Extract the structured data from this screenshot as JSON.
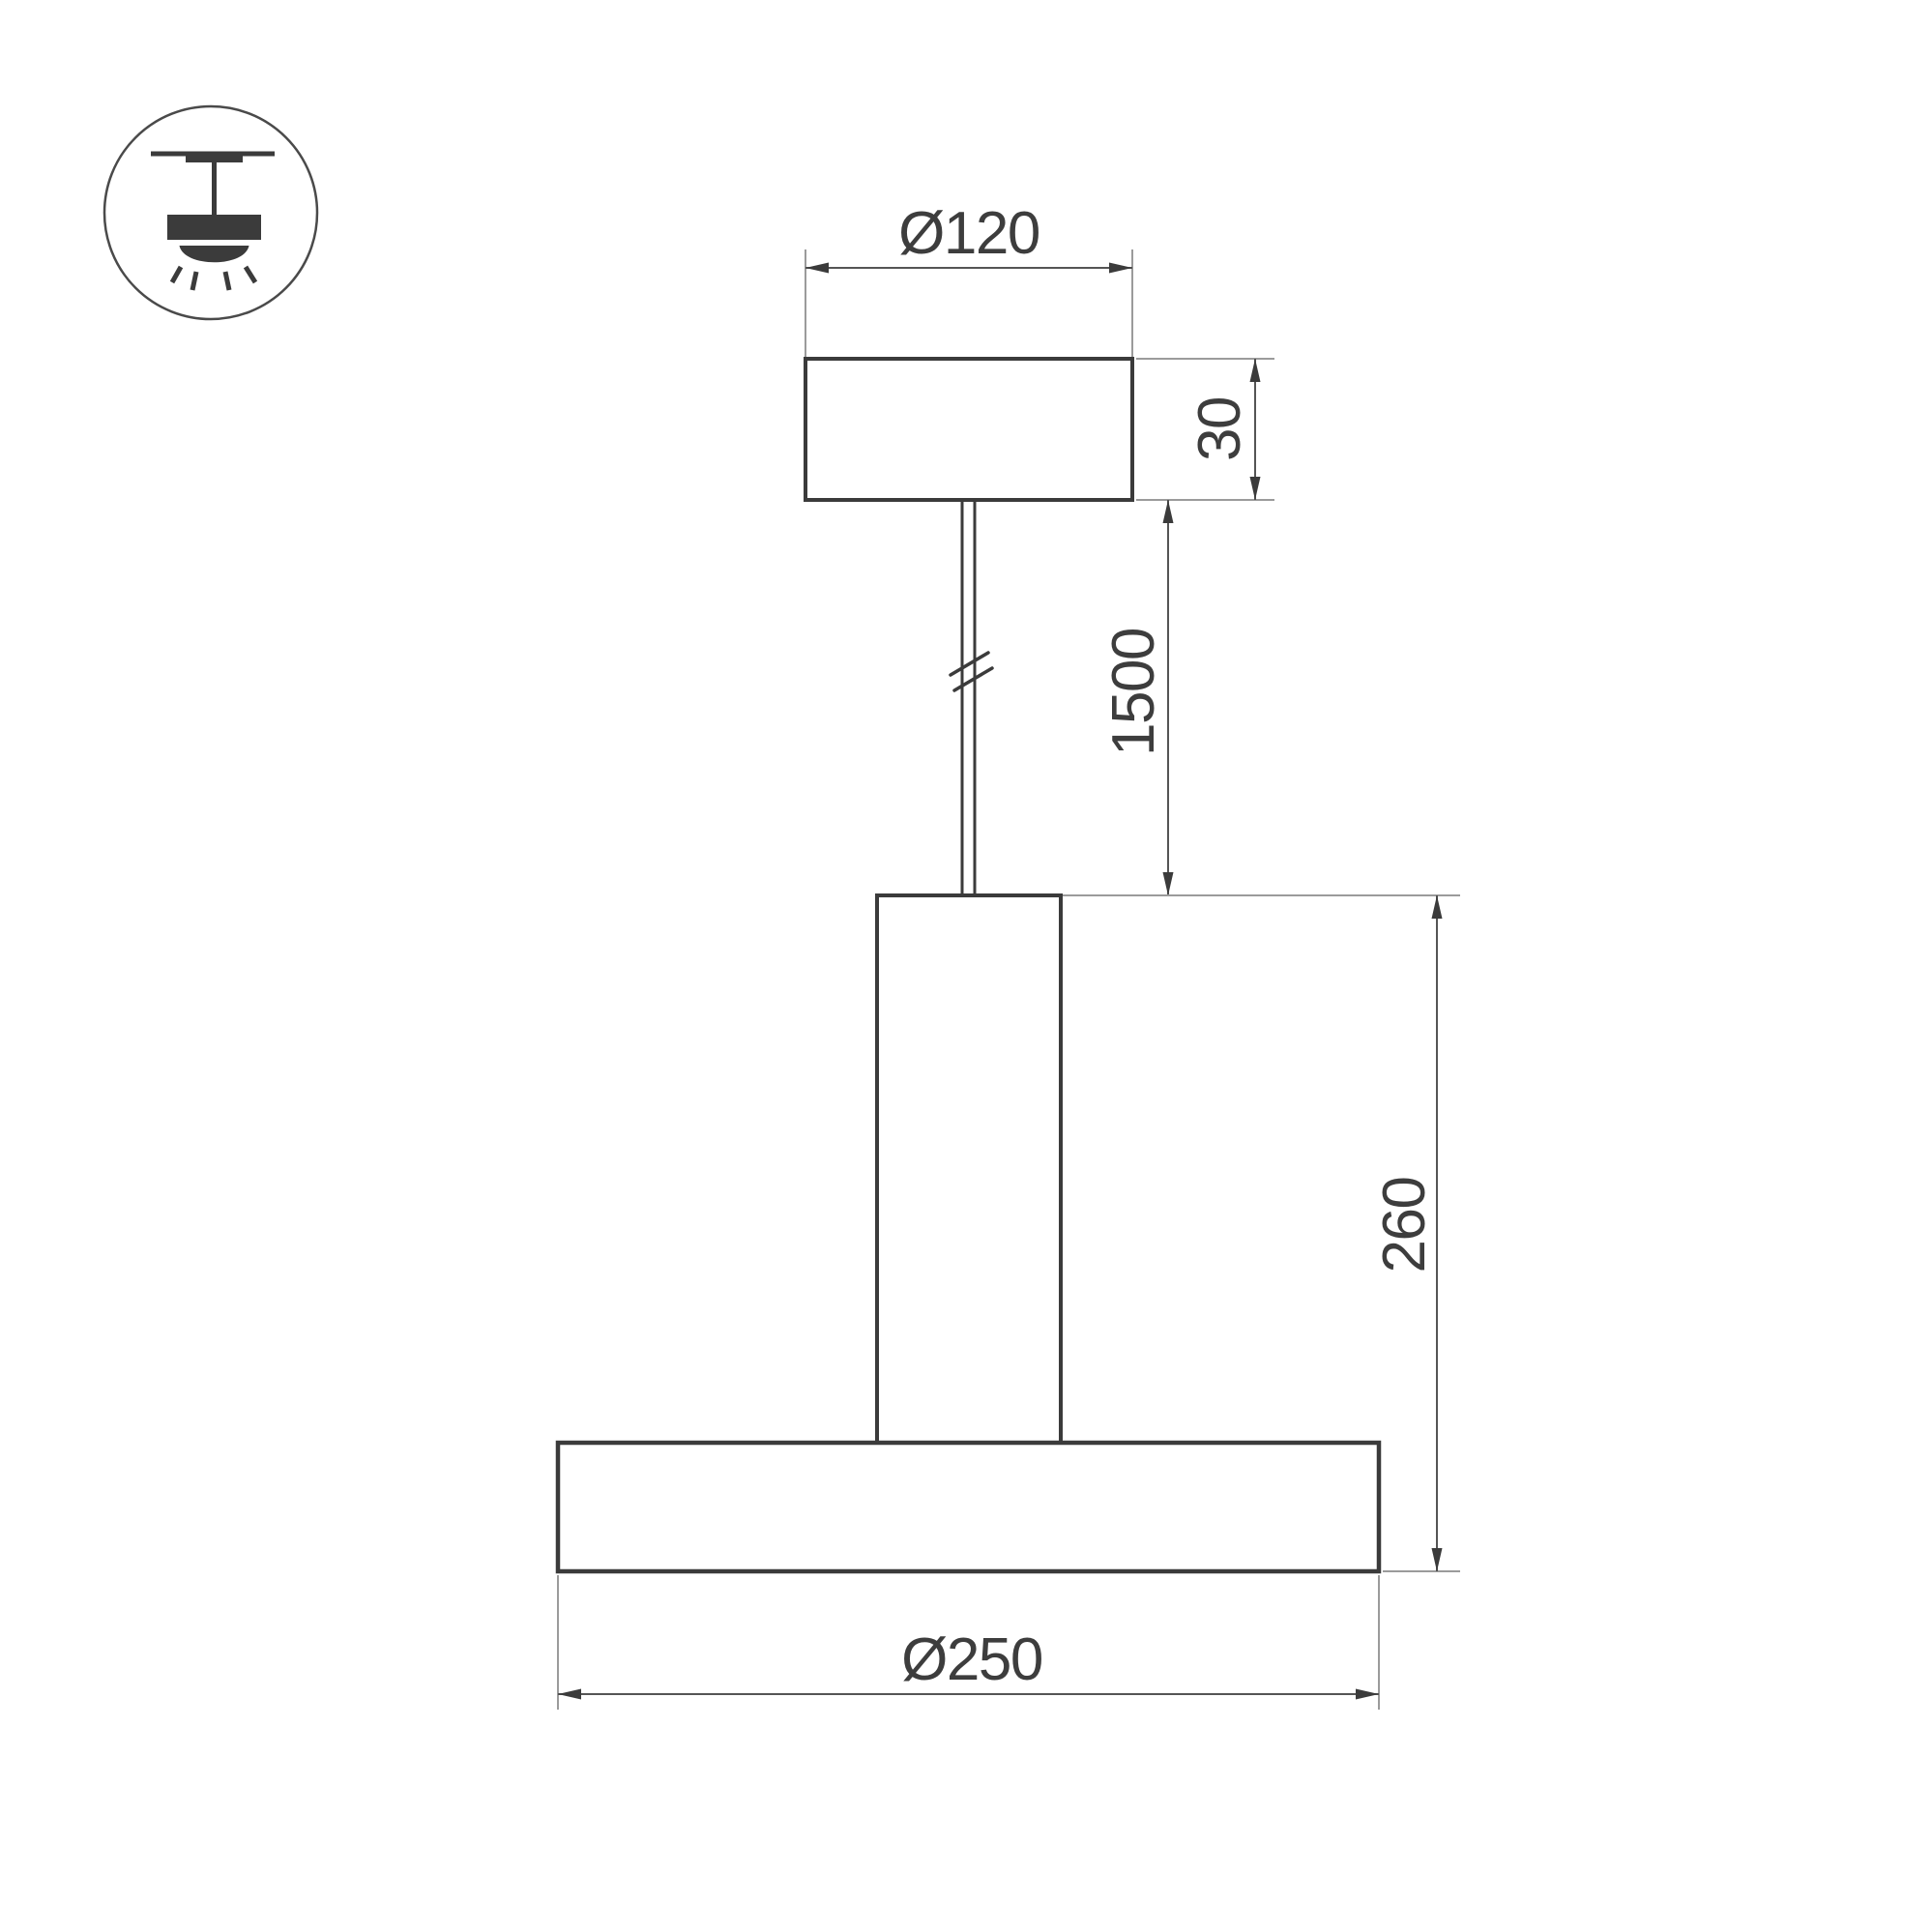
{
  "colors": {
    "background": "#ffffff",
    "outline": "#3b3b3b",
    "dimension_line": "#555555",
    "extension_line": "#9b9b9b",
    "text": "#3d3d3d",
    "icon_circle": "#4a4a4a"
  },
  "icon": {
    "name": "pendant-lamp-icon"
  },
  "drawing": {
    "dimension_labels": {
      "canopy_diameter": "Ø120",
      "canopy_height": "30",
      "suspension_length": "1500",
      "fixture_height": "260",
      "shade_diameter": "Ø250"
    }
  }
}
